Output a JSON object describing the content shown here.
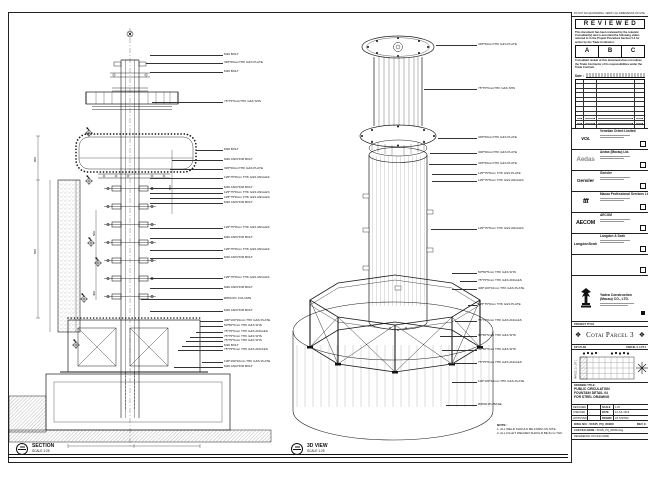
{
  "sheet": {
    "top_strip": "DO NOT SCALE DRAWING. VERIFY ALL DIMENSIONS ON SITE."
  },
  "review_stamp": {
    "title": "R E V I E W E D",
    "para1": "This document has been reviewed by the relevant Consultant(s) and is accorded the following status referred to in the Project Procedure Section 5.4 for action by the Trade Contractor.",
    "cols": [
      "A",
      "B",
      "C"
    ],
    "para2": "Consultant review of this document does not relieve the Trade Contractor of its responsibilities under the Trade Contract.",
    "date_label": "Date :"
  },
  "consultants": [
    {
      "logo": "VOL",
      "name": "Venetian Orient Limited"
    },
    {
      "logo": "Aedas",
      "name": "Aedas (Macau) Ltd."
    },
    {
      "logo": "Gensler",
      "name": "Gensler"
    },
    {
      "logo": "ttt",
      "name": "Macau Professional Services Ltd."
    },
    {
      "logo": "AECOM",
      "name": "AECOM"
    },
    {
      "logo": "LangdonSeah",
      "name": "Langdon & Seah"
    },
    {
      "logo": "",
      "name": ""
    }
  ],
  "contractor": {
    "name_line1": "Yadea Construction",
    "name_line2": "(Macau) CO., LTD."
  },
  "project": {
    "label": "PROJECT TITLE",
    "title": "Cotai Parcel 3",
    "ornament": "❖"
  },
  "key_plan": {
    "label": "KEY PLAN",
    "lot_right": "PARCEL 3, LOT 2",
    "lot_side": "PARCEL 3, LOT 1"
  },
  "drawing_title": {
    "label": "DRAWING TITLE:",
    "lines": [
      "PUBLIC CIRCULATION",
      "FOUNTAIN DETAIL 04",
      "FOR STEEL DRAWING"
    ]
  },
  "title_block": {
    "rows": [
      {
        "l": "DESIGNED",
        "lv": "",
        "r": "SCALE",
        "rv": "1:25"
      },
      {
        "l": "CHECKED",
        "lv": "-",
        "r": "DATE",
        "rv": "14 JUL 2015"
      },
      {
        "l": "APPROVED",
        "lv": "-",
        "r": "DRAWN",
        "rv": "AS SHOWN"
      }
    ],
    "dwg_label": "DWG NO :",
    "dwg_no": "51535_PQ_80000",
    "rev": "REV C",
    "cad_label": "CAD FILE NAME :",
    "cad_file": "51535_PQ_80000.dwg",
    "ref": "REFERENCE ON FILE NAME"
  },
  "left_view": {
    "name": "SECTION",
    "scale": "SCALE 1:25",
    "callouts": [
      {
        "y": 55,
        "lx": 150,
        "text": "M20 BOLT"
      },
      {
        "y": 63,
        "lx": 146,
        "text": "345*50mmTHK G&S PLATE"
      },
      {
        "y": 72,
        "lx": 150,
        "text": "M20 BOLT"
      },
      {
        "y": 102,
        "lx": 152,
        "text": "75*75*6mmTHK G&S SHS"
      },
      {
        "y": 150,
        "lx": 196,
        "text": "M20 BOLT"
      },
      {
        "y": 160,
        "lx": 172,
        "text": "M20 ANCHOR BOLT"
      },
      {
        "y": 169,
        "lx": 170,
        "text": "345*50mmTHK G&S PLATE"
      },
      {
        "y": 178,
        "lx": 150,
        "text": "125*75*8mm THK G&S ANGLES"
      },
      {
        "y": 188,
        "lx": 150,
        "text": "M20 ANCHOR BOLT"
      },
      {
        "y": 193,
        "lx": 150,
        "text": "125*75*8mm THK G&S ANGLES"
      },
      {
        "y": 198,
        "lx": 150,
        "text": "125*75*8mm THK G&S ANGLES"
      },
      {
        "y": 203,
        "lx": 150,
        "text": "M20 ANCHOR BOLT"
      },
      {
        "y": 228,
        "lx": 150,
        "text": "125*75*8mm THK G&S ANGLES"
      },
      {
        "y": 238,
        "lx": 150,
        "text": "M20 ANCHOR BOLT"
      },
      {
        "y": 250,
        "lx": 150,
        "text": "125*75*8mm THK G&S ANGLES"
      },
      {
        "y": 258,
        "lx": 150,
        "text": "M20 ANCHOR BOLT"
      },
      {
        "y": 278,
        "lx": 150,
        "text": "125*75*8mm THK G&S ANGLES"
      },
      {
        "y": 288,
        "lx": 150,
        "text": "M20 ANCHOR BOLT"
      },
      {
        "y": 299,
        "lx": 141,
        "text": "Ø350 RC COLUMN"
      },
      {
        "y": 311,
        "lx": 150,
        "text": "M20 ANCHOR BOLT"
      },
      {
        "y": 321,
        "lx": 200,
        "text": "400*100*10mm THK G&S PLATE"
      },
      {
        "y": 326,
        "lx": 200,
        "text": "50*50*5mm THK G&S SHS"
      },
      {
        "y": 332,
        "lx": 196,
        "text": "75*75*6mm THK G&S ANGLES"
      },
      {
        "y": 337,
        "lx": 190,
        "text": "75*75*6mm THK G&S SHS"
      },
      {
        "y": 341,
        "lx": 186,
        "text": "75*75*6mm THK G&S SHS"
      },
      {
        "y": 346,
        "lx": 182,
        "text": "M20 BOLT"
      },
      {
        "y": 350,
        "lx": 178,
        "text": "75*75*6mm THK G&S ANGLES"
      },
      {
        "y": 362,
        "lx": 202,
        "text": "100*100*10mm THK G&S PLATE"
      },
      {
        "y": 367,
        "lx": 174,
        "text": "M20 ANCHOR BOLT"
      }
    ],
    "dims": [
      {
        "x": 34,
        "y": 162,
        "t": "800"
      },
      {
        "x": 34,
        "y": 254,
        "t": "500"
      },
      {
        "x": 169,
        "y": 190,
        "t": "500"
      },
      {
        "x": 93,
        "y": 236,
        "t": "500"
      },
      {
        "x": 93,
        "y": 296,
        "t": "400"
      }
    ]
  },
  "mid_view": {
    "name": "3D VIEW",
    "scale": "SCALE 1:25",
    "callouts": [
      {
        "y": 45,
        "lx": 436,
        "text": "345*50mmTHK G&S PLATE"
      },
      {
        "y": 89,
        "lx": 424,
        "text": "75*75*6mmTHK G&S SHS"
      },
      {
        "y": 138,
        "lx": 438,
        "text": "345*50mmTHK G&S PLATE"
      },
      {
        "y": 153,
        "lx": 430,
        "text": "300*50mmTHK G&S PLATE"
      },
      {
        "y": 164,
        "lx": 429,
        "text": "345*50mmTHK G&S PLATE"
      },
      {
        "y": 174,
        "lx": 432,
        "text": "125*75*8mm THK G&S PLATE"
      },
      {
        "y": 181,
        "lx": 432,
        "text": "125*75*8mm THK G&S ANGLES"
      },
      {
        "y": 229,
        "lx": 431,
        "text": "125*75*8mm THK G&S ANGLES"
      },
      {
        "y": 273,
        "lx": 452,
        "text": "50*50*5mm THK G&S SHS"
      },
      {
        "y": 281,
        "lx": 460,
        "text": "75*75*6mm THK G&S ANGLES"
      },
      {
        "y": 289,
        "lx": 452,
        "text": "400*100*10mm THK G&S PLATE"
      },
      {
        "y": 305,
        "lx": 468,
        "text": "125*75*8mm THK G&S PLATE"
      },
      {
        "y": 321,
        "lx": 455,
        "text": "75*75*6mm THK G&S ANGLES"
      },
      {
        "y": 336,
        "lx": 440,
        "text": "50*50*5mm THK G&S SHS"
      },
      {
        "y": 350,
        "lx": 442,
        "text": "50*50*5mm THK G&S SHS"
      },
      {
        "y": 363,
        "lx": 448,
        "text": "75*75*6mm THK G&S ANGLES"
      },
      {
        "y": 382,
        "lx": 452,
        "text": "100*100*10mm THK G&S PLATE"
      },
      {
        "y": 405,
        "lx": 446,
        "text": "Ø3500 RC BASE"
      }
    ],
    "note_title": "NOTE:",
    "notes": [
      "1. ALL WELD SHOULD BE FORM ON SITE.",
      "2. ALL FILLET WELDED SHOULD BE 6mm THK."
    ]
  }
}
